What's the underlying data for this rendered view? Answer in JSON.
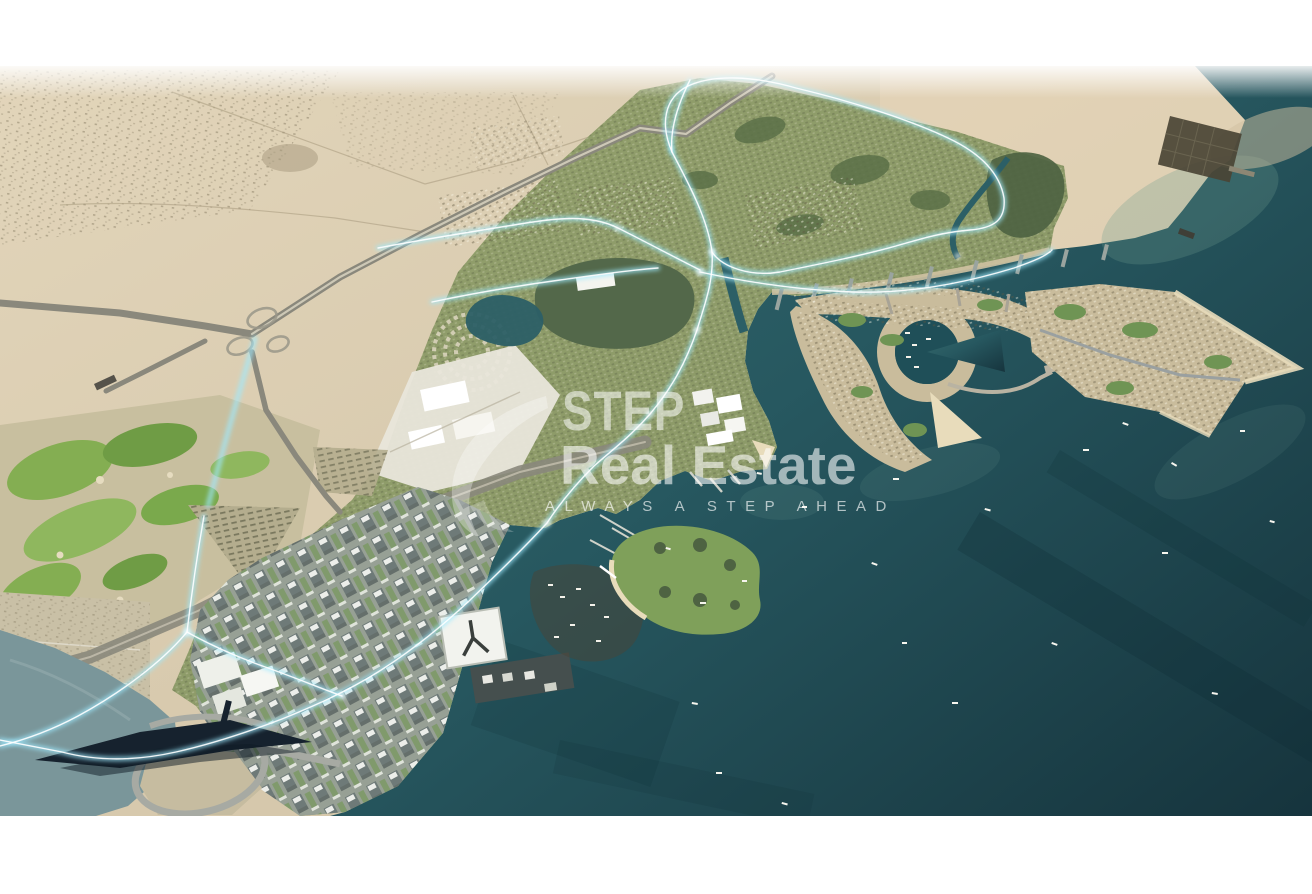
{
  "scene": {
    "description": "Aerial 3D masterplan render of a coastal desert city: desert inland with highway interchange, illuminated cyan road network through green districts, downtown towers, golf course, cable bridge, crescent marina island and arrow-shaped island in a dark teal sea",
    "view": "bird's-eye perspective"
  },
  "watermark": {
    "logo": "step-swoosh-logo",
    "brand_line1": "STEP",
    "brand_line2": "Real Estate",
    "tagline": "ALWAYS A STEP AHEAD"
  },
  "colors": {
    "background": "#ffffff",
    "desert": "#d8caae",
    "desert_light": "#e9dfc8",
    "desert_pink": "#ecd9bd",
    "sea": "#2a5a61",
    "sea_deep": "#16343d",
    "sea_silty": "#7a969a",
    "greenery": "#8e9a6e",
    "tree_park": "#53684a",
    "golf_green": "#84ae52",
    "urban_gray": "#97a095",
    "island_sand": "#c9bc9c",
    "beach": "#e8dcbb",
    "road_gray": "#8a887c",
    "road_glow": "#9feaff",
    "bridge_dark": "#16222e",
    "watermark_white": "#ffffff"
  }
}
